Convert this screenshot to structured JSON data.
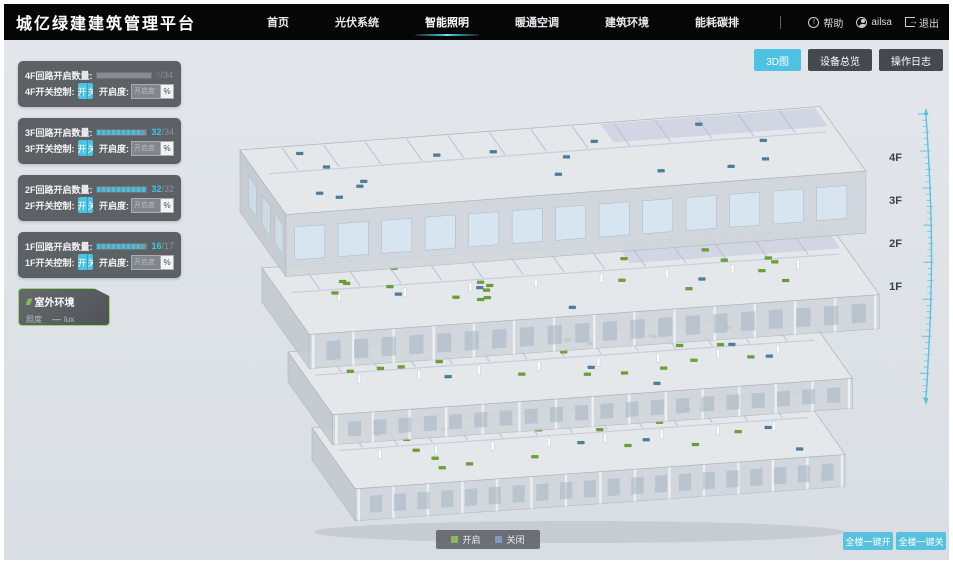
{
  "header": {
    "title": "城亿绿建建筑管理平台",
    "nav": [
      {
        "label": "首页",
        "active": false
      },
      {
        "label": "光伏系统",
        "active": false
      },
      {
        "label": "智能照明",
        "active": true
      },
      {
        "label": "暖通空调",
        "active": false
      },
      {
        "label": "建筑环境",
        "active": false
      },
      {
        "label": "能耗碳排",
        "active": false
      }
    ],
    "help_label": "帮助",
    "username": "ailsa",
    "logout_label": "退出"
  },
  "toolbar": {
    "buttons": [
      {
        "label": "3D图",
        "active": true
      },
      {
        "label": "设备总览",
        "active": false
      },
      {
        "label": "操作日志",
        "active": false
      }
    ]
  },
  "floor_panels": [
    {
      "floor": "4F",
      "count_label": "4F回路开启数量:",
      "count": "0",
      "total": "/34",
      "percent": 0,
      "count_color": "#6a7076",
      "switch_label": "4F开关控制:",
      "on_label": "开",
      "off_label": "关",
      "dim_label": "开启度:",
      "dim_placeholder": "开启度",
      "percent_suffix": "%"
    },
    {
      "floor": "3F",
      "count_label": "3F回路开启数量:",
      "count": "32",
      "total": "/34",
      "percent": 94,
      "count_color": "#3fc6e8",
      "switch_label": "3F开关控制:",
      "on_label": "开",
      "off_label": "关",
      "dim_label": "开启度:",
      "dim_placeholder": "开启度",
      "percent_suffix": "%"
    },
    {
      "floor": "2F",
      "count_label": "2F回路开启数量:",
      "count": "32",
      "total": "/32",
      "percent": 100,
      "count_color": "#3fc6e8",
      "switch_label": "2F开关控制:",
      "on_label": "开",
      "off_label": "关",
      "dim_label": "开启度:",
      "dim_placeholder": "开启度",
      "percent_suffix": "%"
    },
    {
      "floor": "1F",
      "count_label": "1F回路开启数量:",
      "count": "16",
      "total": "/17",
      "percent": 94,
      "count_color": "#3fc6e8",
      "switch_label": "1F开关控制:",
      "on_label": "开",
      "off_label": "关",
      "dim_label": "开启度:",
      "dim_placeholder": "开启度",
      "percent_suffix": "%"
    }
  ],
  "outdoor_panel": {
    "icon": "///",
    "title": "室外环境",
    "metric": "照度",
    "value": "—",
    "unit": "lux"
  },
  "floor_axis": [
    "4F",
    "3F",
    "2F",
    "1F"
  ],
  "legend": [
    {
      "label": "开启",
      "color": "#93b55c"
    },
    {
      "label": "关闭",
      "color": "#7b9cc0"
    }
  ],
  "bottom_buttons": [
    {
      "label": "全楼一键开"
    },
    {
      "label": "全楼一键关"
    }
  ],
  "colors": {
    "accent": "#45c0e0",
    "marker_on": "#6ca32f",
    "marker_off": "#49809f",
    "header_bg": "#060607"
  }
}
